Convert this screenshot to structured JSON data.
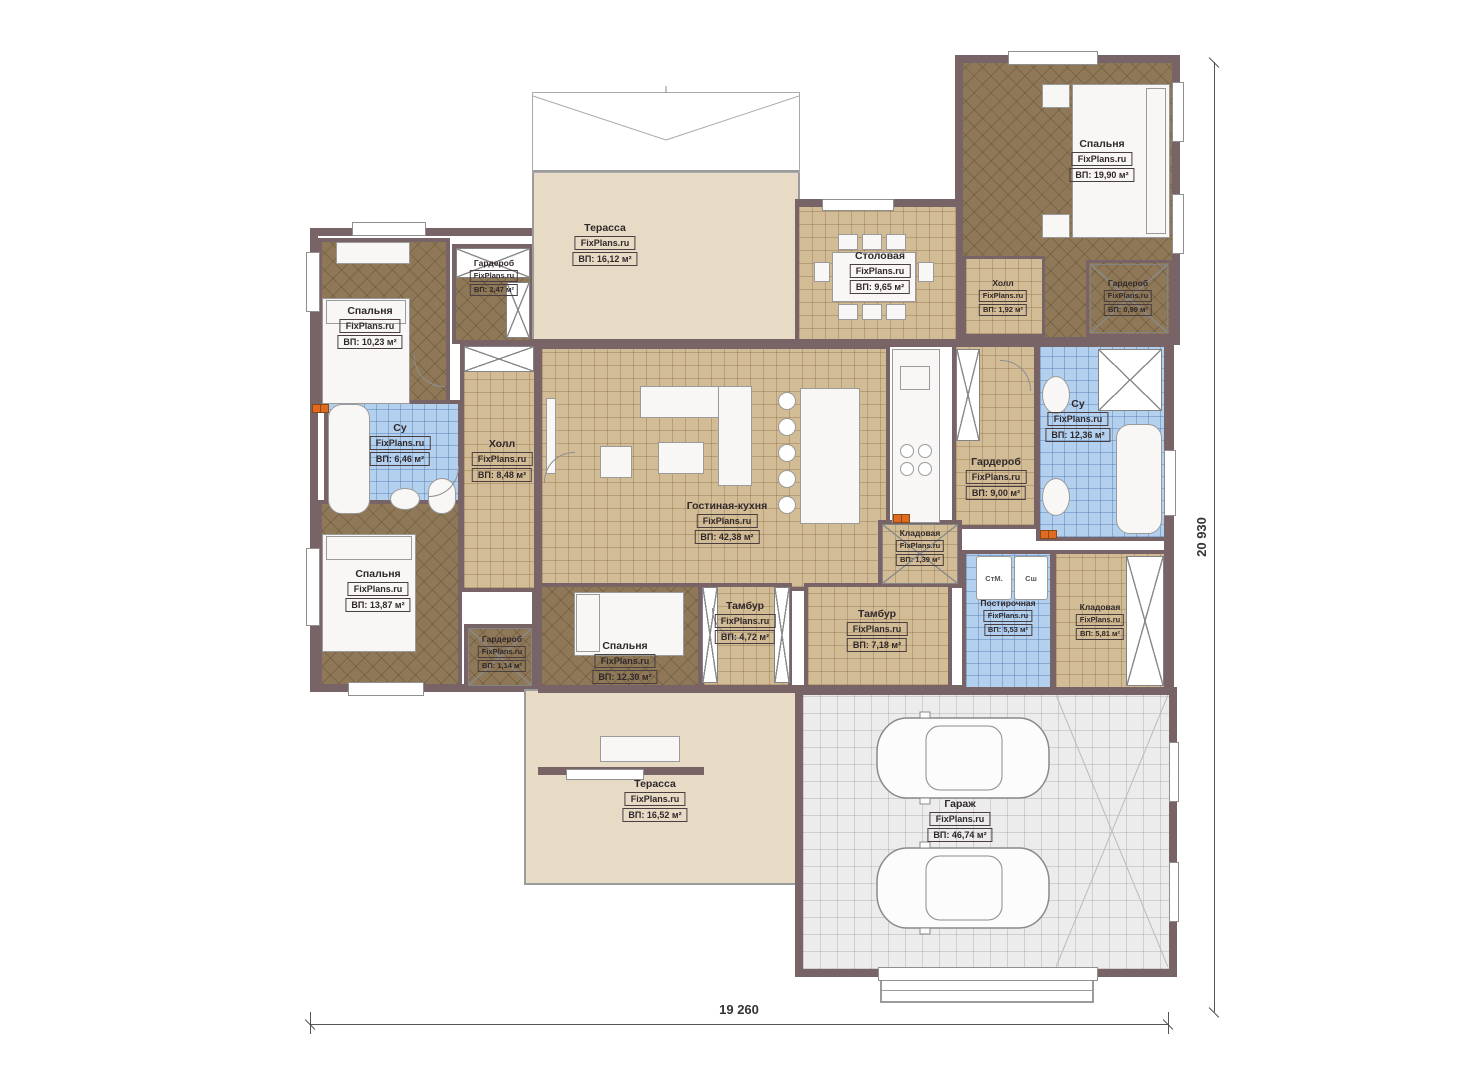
{
  "plan": {
    "watermark": "FixPlans.ru",
    "rooms": [
      {
        "name": "Спальня",
        "area": "ВП: 10,23 м²"
      },
      {
        "name": "Гардероб",
        "area": "ВП: 2,47 м²"
      },
      {
        "name": "Терасса",
        "area": "ВП: 16,12 м²"
      },
      {
        "name": "Столовая",
        "area": "ВП: 9,65 м²"
      },
      {
        "name": "Холл",
        "area": "ВП: 1,92 м²"
      },
      {
        "name": "Спальня",
        "area": "ВП: 19,90 м²"
      },
      {
        "name": "Гардероб",
        "area": "ВП: 0,99 м²"
      },
      {
        "name": "Су",
        "area": "ВП: 6,46 м²"
      },
      {
        "name": "Холл",
        "area": "ВП: 8,48 м²"
      },
      {
        "name": "Су",
        "area": "ВП: 12,36 м²"
      },
      {
        "name": "Гардероб",
        "area": "ВП: 9,00 м²"
      },
      {
        "name": "Гостиная-кухня",
        "area": "ВП: 42,38 м²"
      },
      {
        "name": "Кладовая",
        "area": "ВП: 1,39 м²"
      },
      {
        "name": "Спальня",
        "area": "ВП: 13,87 м²"
      },
      {
        "name": "Гардероб",
        "area": "ВП: 1,14 м²"
      },
      {
        "name": "Спальня",
        "area": "ВП: 12,30 м²"
      },
      {
        "name": "Тамбур",
        "area": "ВП: 4,72 м²"
      },
      {
        "name": "Тамбур",
        "area": "ВП: 7,18 м²"
      },
      {
        "name": "Постирочная",
        "area": "ВП: 5,53 м²"
      },
      {
        "name": "Кладовая",
        "area": "ВП: 5,81 м²"
      },
      {
        "name": "Терасса",
        "area": "ВП: 16,52 м²"
      },
      {
        "name": "Гараж",
        "area": "ВП: 46,74 м²"
      }
    ],
    "appliances": {
      "washer": "СтМ.",
      "dryer": "Сш"
    },
    "dimensions": {
      "width": "19 260",
      "height": "20 930"
    },
    "colors": {
      "wall": "#786466",
      "wood": "#8e7857",
      "tile": "#d2bc96",
      "wet": "#b3d1ef",
      "terrace": "#e7dbc6",
      "garage": "#ececec"
    }
  }
}
